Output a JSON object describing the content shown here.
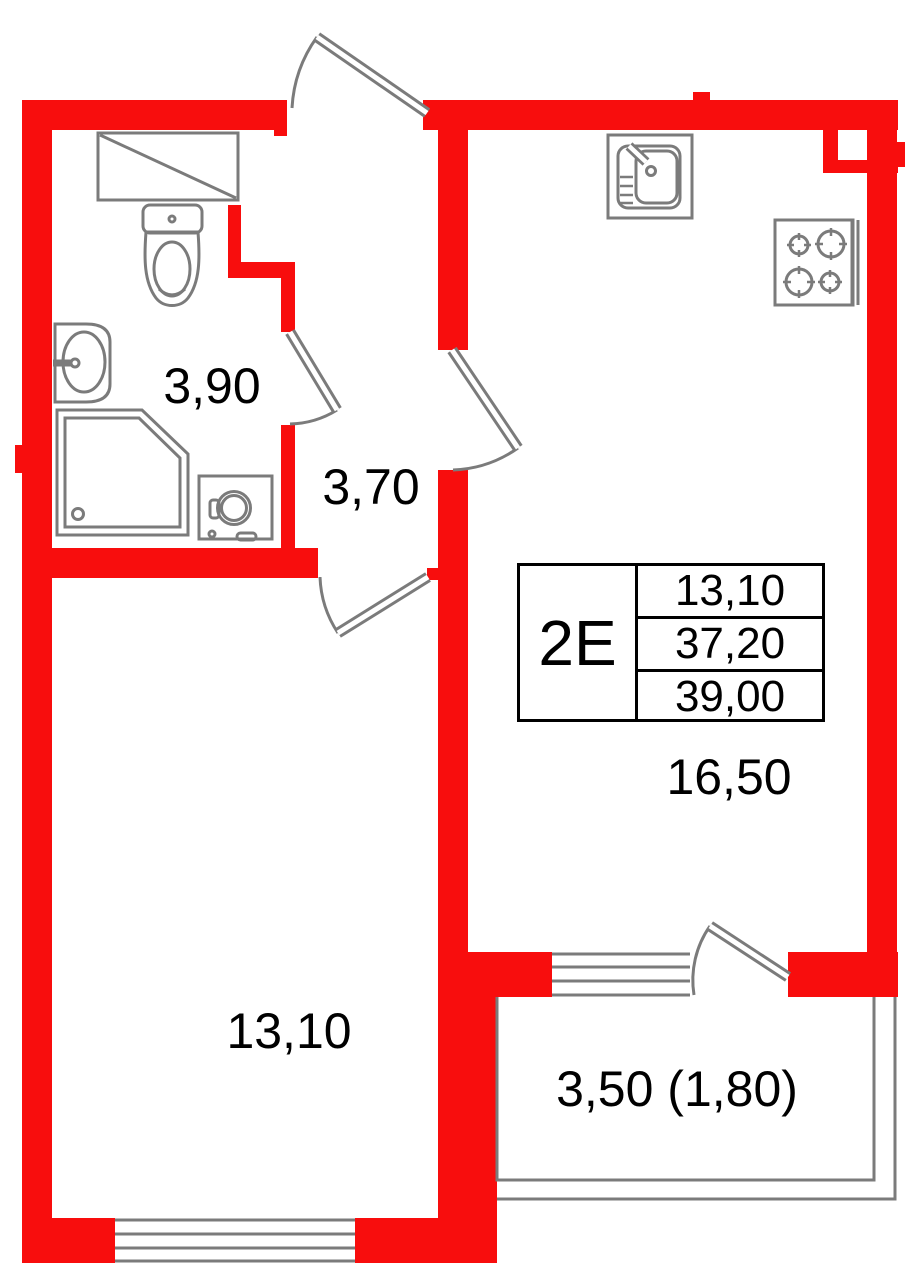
{
  "plan": {
    "colors": {
      "wall": "#f80d0d",
      "fixture": "#7b7b7b",
      "text": "#000000"
    },
    "info_box": {
      "unit_type": "2Е",
      "living_area": "13,10",
      "area_no_balcony": "37,20",
      "total_area": "39,00"
    },
    "room_labels": {
      "bathroom": "3,90",
      "hallway": "3,70",
      "room": "13,10",
      "kitchen": "16,50",
      "balcony": "3,50 (1,80)"
    }
  }
}
